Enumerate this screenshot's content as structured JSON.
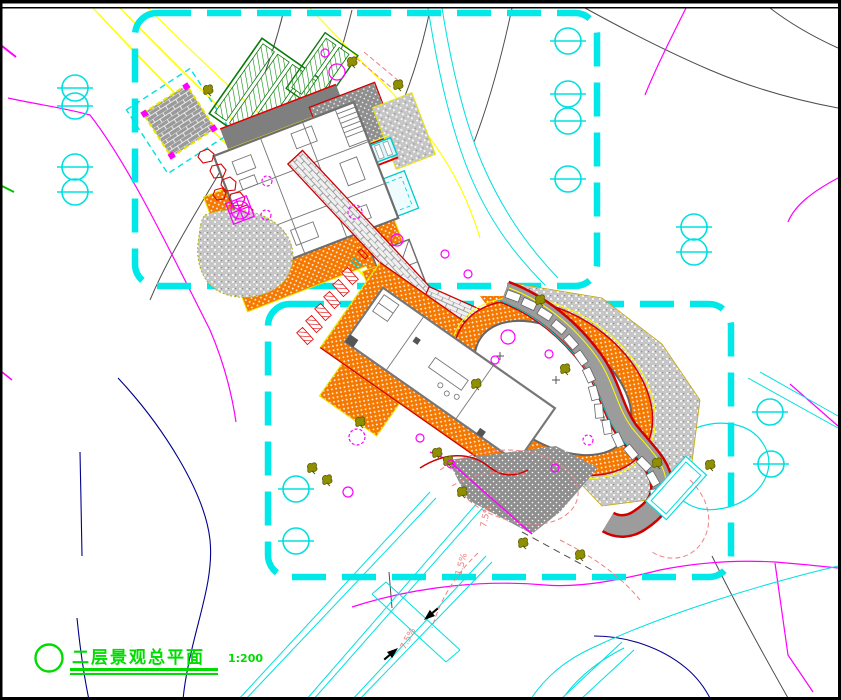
{
  "drawing": {
    "title": "二层景观总平面",
    "scale": "1:200",
    "slope_labels": [
      {
        "text": "7.5%"
      },
      {
        "text": "1.5%"
      },
      {
        "text": "7.5%"
      }
    ],
    "legend": {
      "boundary_dashed": "#00E8E8",
      "paving_orange": "#F57900",
      "gravel_gray": "#8F8F8F",
      "edge_red": "#E60000",
      "road_yellow": "#FFFF00",
      "planting_magenta": "#FF00FF",
      "contour_gray": "#4D4D4D",
      "contour_blue": "#00008B",
      "water_cyan": "#00FFFF",
      "title_green": "#00DC00",
      "slope_label_pink": "#F08080",
      "tree_olive": "#8F8F00",
      "roof_hatch_green": "#0B8A0B"
    },
    "symbols": {
      "survey-marker": "cyan circle with horizontal bar",
      "tree": "olive canopy blob",
      "shrub": "magenta circle",
      "rockery": "red stone outline",
      "flow-arrow": "black arrow on path"
    }
  }
}
